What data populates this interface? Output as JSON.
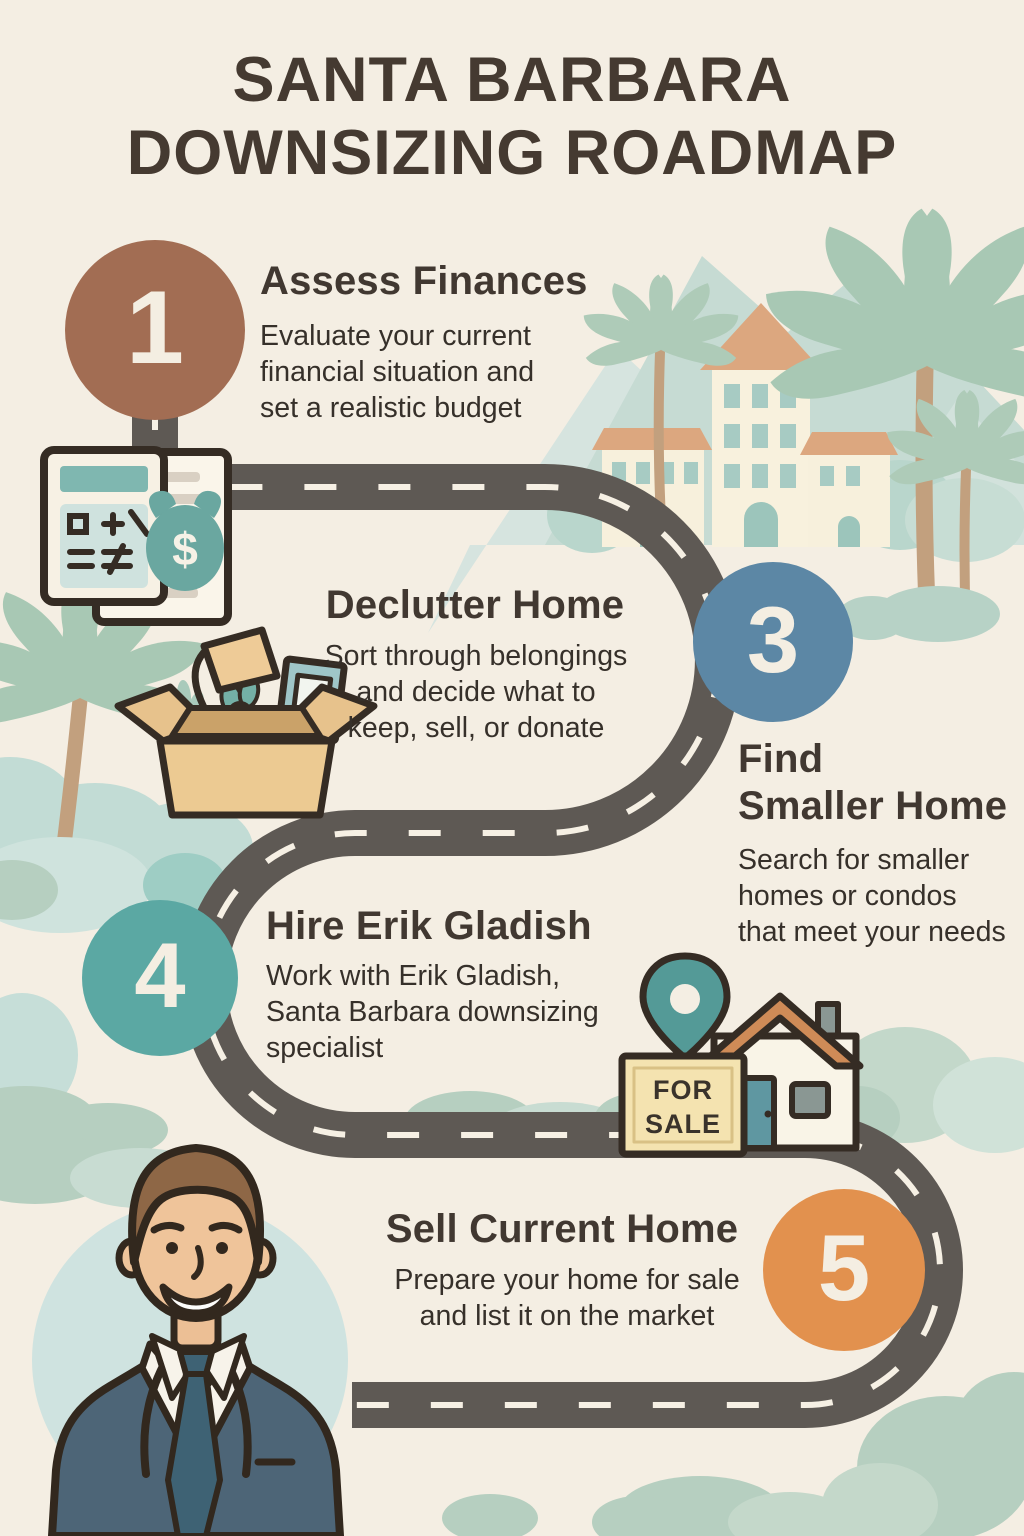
{
  "title": "SANTA BARBARA\nDOWNSIZING ROADMAP",
  "steps": [
    {
      "number": "1",
      "title": "Assess Finances",
      "description": "Evaluate your current\nfinancial situation and\nset a realistic budget"
    },
    {
      "number": "",
      "title": "Declutter Home",
      "description": "Sort through belongings\nand decide what to\nkeep, sell, or donate"
    },
    {
      "number": "3",
      "title": "Find\nSmaller Home",
      "description": "Search for smaller\nhomes or condos\nthat meet your needs"
    },
    {
      "number": "4",
      "title": "Hire Erik Gladish",
      "description": "Work with Erik Gladish,\nSanta Barbara downsizing\nspecialist"
    },
    {
      "number": "5",
      "title": "Sell Current Home",
      "description": "Prepare your home for sale\nand list it on the market"
    }
  ],
  "for_sale_sign": "FOR\nSALE",
  "money_symbol": "$",
  "colors": {
    "background": "#f4eee3",
    "title_text": "#453a31",
    "body_text": "#36302a",
    "road": "#5e5954",
    "road_dash": "#f6f0e4",
    "step1_circle": "#a26d53",
    "step3_circle": "#5c87a5",
    "step4_circle": "#5ba8a3",
    "step5_circle": "#e2914e",
    "number_text": "#f4eee2",
    "sage_green": "#b6cfc0",
    "mountain_green": "#c6dbd3",
    "palm_green": "#a8c8b4",
    "palm_trunk": "#c2a07e",
    "building_cream": "#f8f1dd",
    "roof_terracotta": "#dca77f",
    "window_teal": "#a7cbc3",
    "money_teal": "#6aa7a0",
    "house_roof_orange": "#cf8b57",
    "door_teal": "#5f97a1",
    "map_pin_teal": "#549a97",
    "sign_tan": "#f4e3b0",
    "box_tan": "#ecca92",
    "suit_blue": "#4d6577",
    "tie_teal": "#3e6274",
    "skin_tone": "#efc49a",
    "hair_brown": "#8e6746",
    "portrait_circle": "#cfe3e0",
    "outline_dark": "#32291f"
  },
  "icons": [
    "calculator-icon",
    "document-icon",
    "money-bag-icon",
    "moving-box-icon",
    "lamp-icon",
    "plant-icon",
    "picture-frame-icon",
    "map-pin-icon",
    "for-sale-sign",
    "house-icon",
    "agent-portrait",
    "palm-tree-icon",
    "mountains",
    "bushes",
    "winding-road"
  ]
}
